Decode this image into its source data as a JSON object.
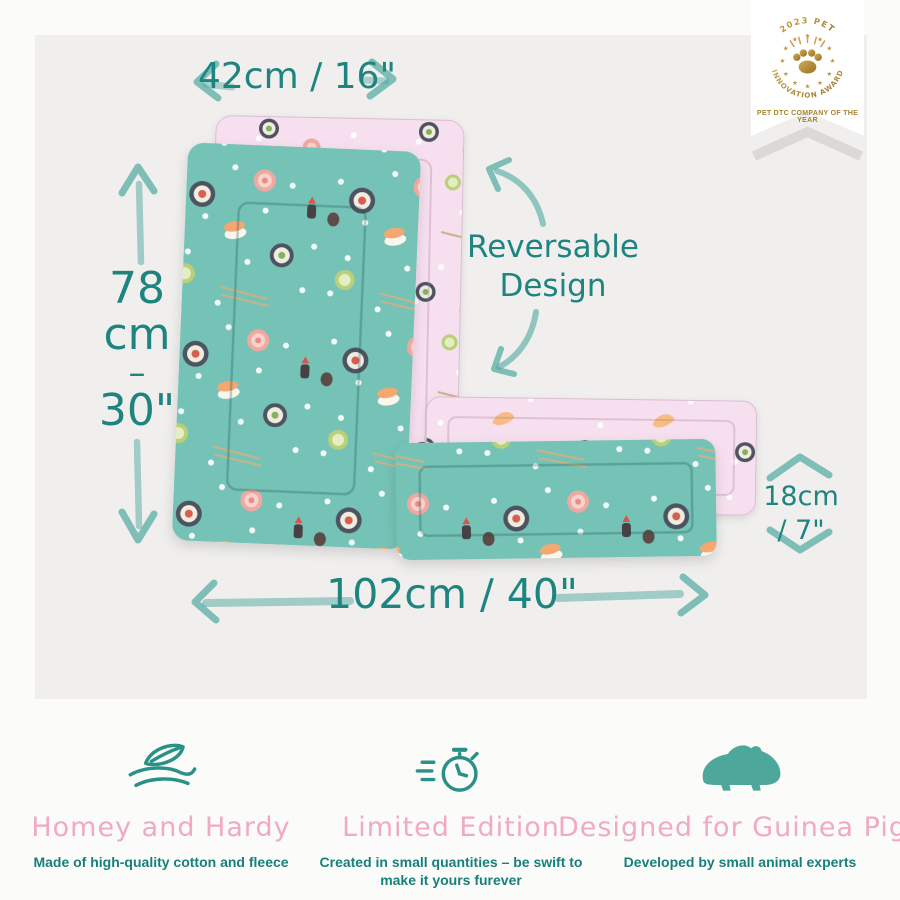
{
  "award": {
    "arc_top": "2023 PET",
    "arc_bottom": "INNOVATION AWARD",
    "tagline": "PET DTC COMPANY OF THE YEAR",
    "star_glyph": "★"
  },
  "measurements": {
    "top_width": "42cm / 16\"",
    "left_height": {
      "value": "78",
      "unit": "cm",
      "dash": "–",
      "inches": "30\""
    },
    "right_height": {
      "line1": "18cm",
      "line2": "/ 7\""
    },
    "bottom_width": "102cm / 40\""
  },
  "callout": {
    "line1": "Reversable",
    "line2": "Design"
  },
  "mats": {
    "front": "teal-sushi-pattern",
    "reverse": "pink-sushi-pattern"
  },
  "features": [
    {
      "icon": "cozy-fabric-icon",
      "title": "Homey and Hardy",
      "description": "Made of high-quality cotton and fleece"
    },
    {
      "icon": "stopwatch-icon",
      "title": "Limited Edition",
      "description": "Created in small quantities – be swift to make it yours furever"
    },
    {
      "icon": "guinea-pig-icon",
      "title": "Designed for Guinea Pigs",
      "description": "Developed by small animal experts"
    }
  ],
  "colors": {
    "background": "#fbfbf9",
    "panel": "#f0efed",
    "mat_teal": "#74c3b6",
    "mat_pink": "#f6e0ef",
    "text_teal": "#1e8480",
    "chalk_teal": "#4fa89f",
    "title_pink": "#f0a9c6",
    "desc_teal": "#17807c",
    "gold": "#b6923c"
  }
}
